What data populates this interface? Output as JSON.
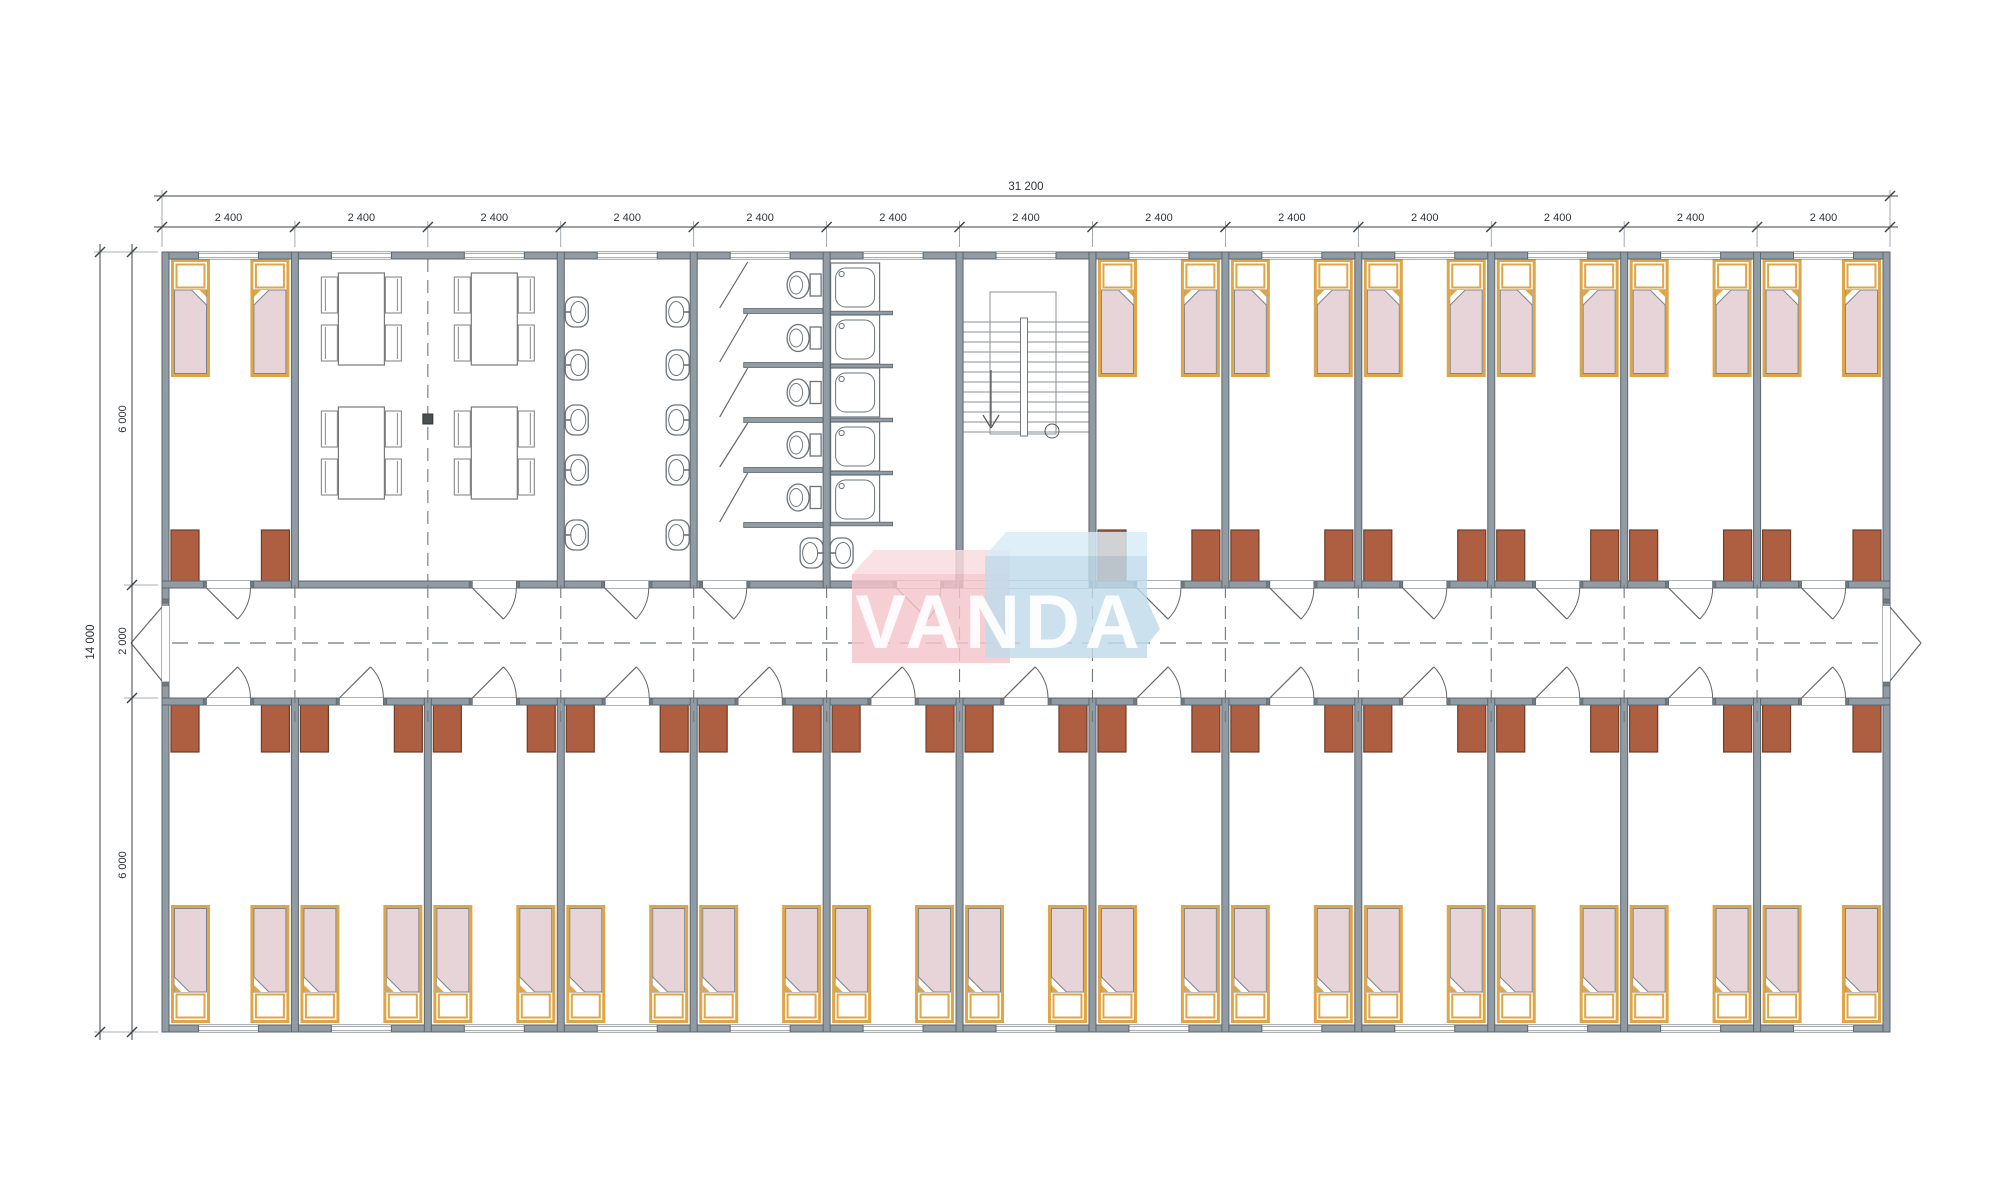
{
  "logo": {
    "text": "VANDA",
    "pink_face": "#F4C4CC",
    "pink_top": "#F9DAE0",
    "blue_face": "#BFDAEA",
    "blue_top": "#D8EBF5",
    "text_color": "rgba(255,255,255,0.92)"
  },
  "dimensions": {
    "top_total": "31 200",
    "top_segments": [
      "2 400",
      "2 400",
      "2 400",
      "2 400",
      "2 400",
      "2 400",
      "2 400",
      "2 400",
      "2 400",
      "2 400",
      "2 400",
      "2 400",
      "2 400"
    ],
    "left_total": "14 000",
    "left_segments": [
      "6 000",
      "2 000",
      "6 000"
    ]
  },
  "plan": {
    "top_row": [
      "bedroom",
      "dining",
      "dining",
      "sink-room",
      "toilet-room",
      "shower-room",
      "stairwell",
      "bedroom",
      "bedroom",
      "bedroom",
      "bedroom",
      "bedroom",
      "bedroom"
    ],
    "bottom_row": [
      "bedroom",
      "bedroom",
      "bedroom",
      "bedroom",
      "bedroom",
      "bedroom",
      "bedroom",
      "bedroom",
      "bedroom",
      "bedroom",
      "bedroom",
      "bedroom",
      "bedroom"
    ],
    "fixtures": {
      "sink_columns": 2,
      "sinks_per_column": 5,
      "lobby_sinks": 2,
      "toilet_stalls": 5,
      "shower_trays": 5,
      "dining_tables": 4,
      "chairs_per_table": 4,
      "beds_per_room": 2,
      "wardrobes_per_room": 2
    }
  },
  "colors": {
    "background": "#FFFFFF",
    "wall_fill": "#909BA3",
    "wall_stroke": "#5D666E",
    "wall_cap": "#707A82",
    "bed_frame": "#DFA647",
    "bed_blanket": "#E6D4D8",
    "blanket_stroke": "#80838B",
    "wardrobe_fill": "#AE5E41",
    "wardrobe_stroke": "#6E3D26",
    "fixture_stroke": "#6A737B",
    "dash_line": "#6F777E",
    "dimension_line": "#3C4146",
    "dimension_text": "#2E3338"
  }
}
